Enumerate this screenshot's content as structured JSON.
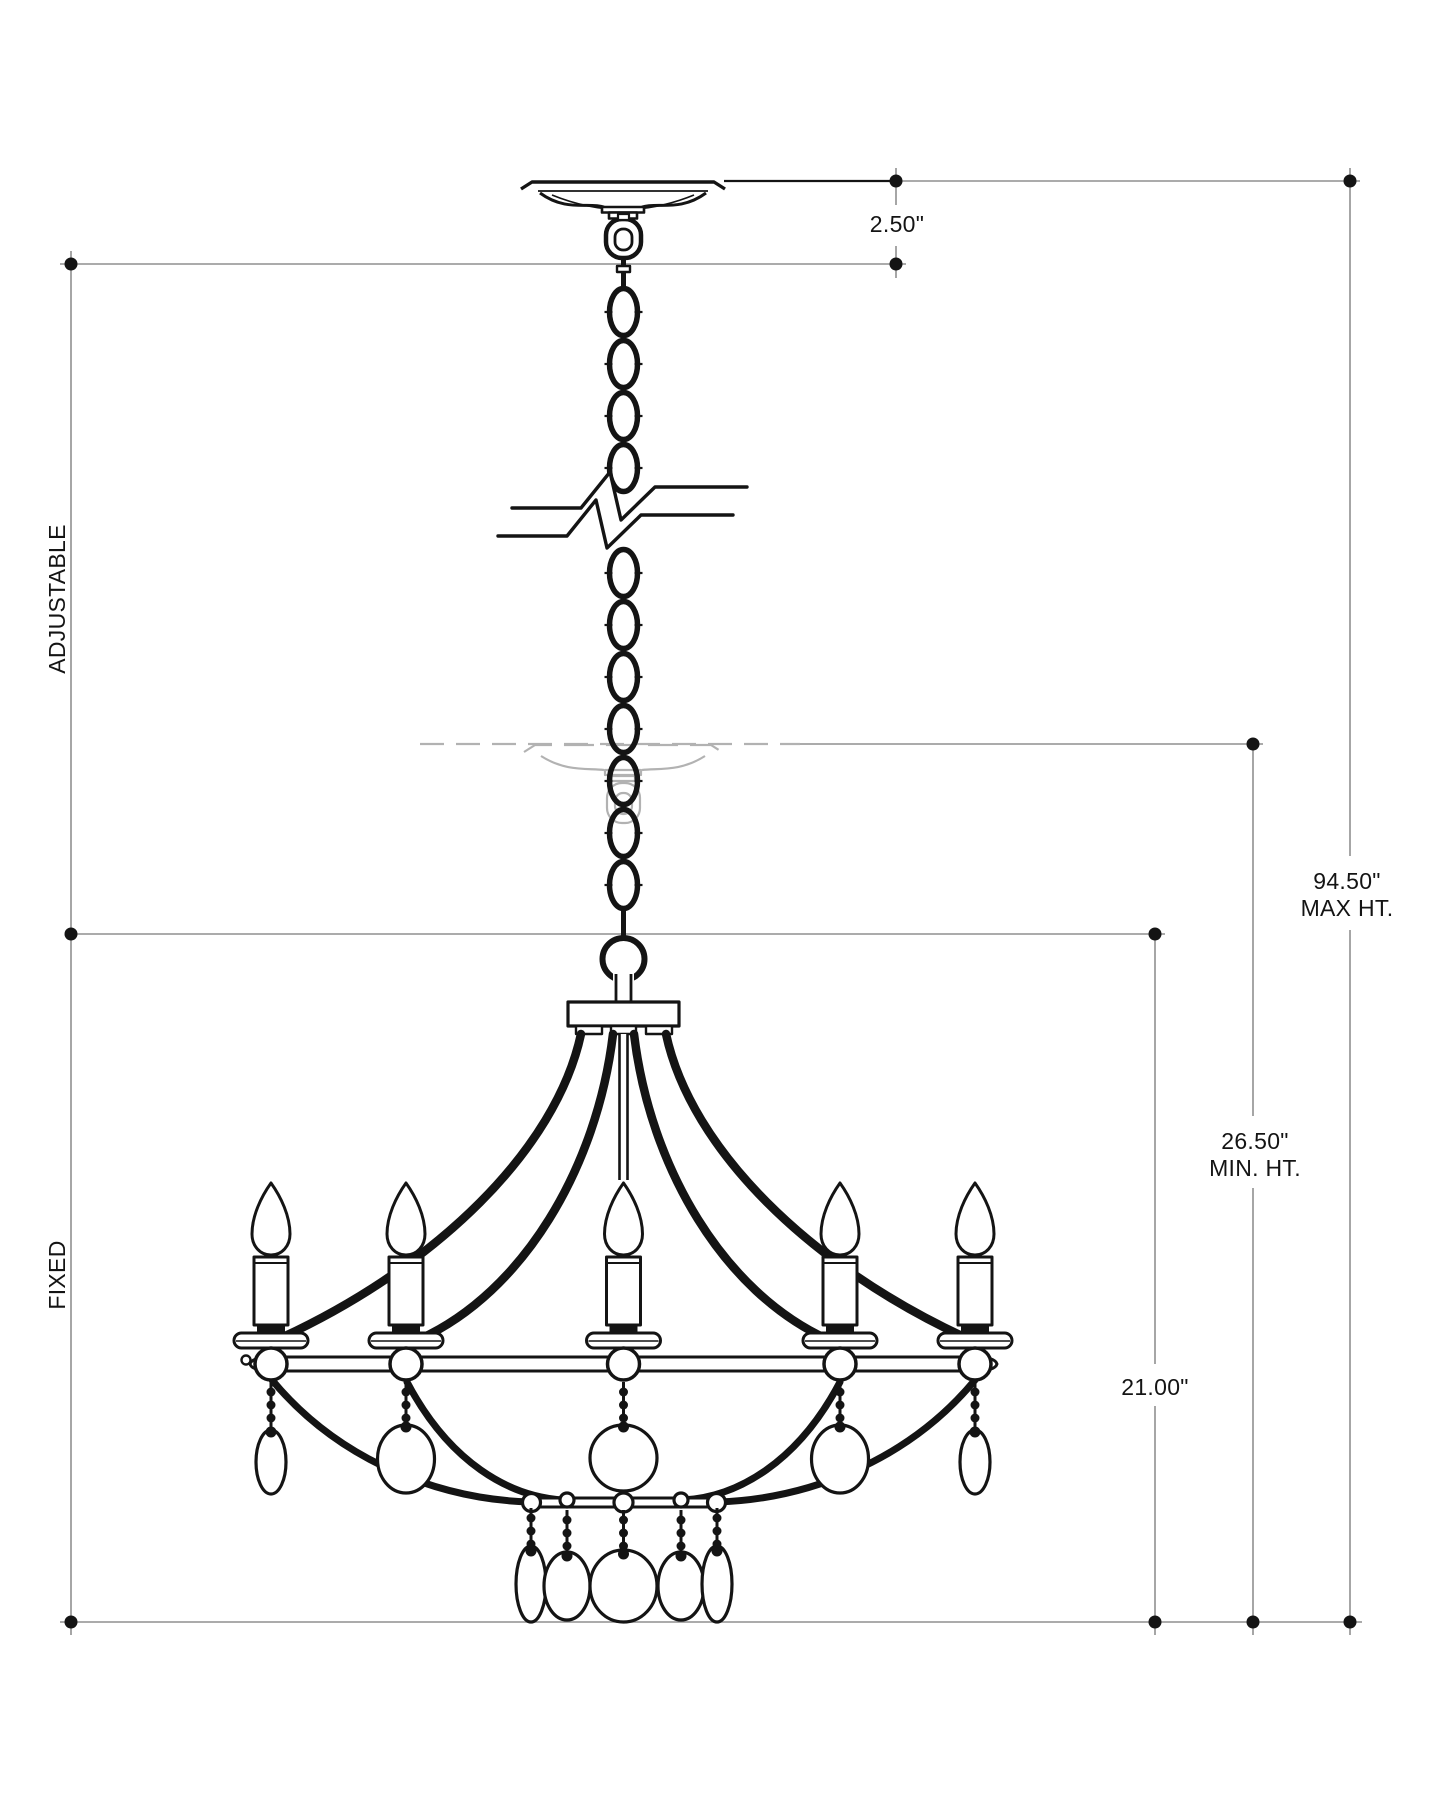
{
  "title": "Chandelier installation dimension drawing",
  "colors": {
    "ink": "#141414",
    "dimline": "#8f8f8f",
    "ghost": "#b2b2b2",
    "paper": "#ffffff"
  },
  "dimensions": {
    "canopy_height": {
      "value": "2.50\""
    },
    "max_height": {
      "value": "94.50\"",
      "caption": "MAX HT."
    },
    "min_height": {
      "value": "26.50\"",
      "caption": "MIN. HT."
    },
    "fixture_height": {
      "value": "21.00\""
    },
    "adjustable_label": "ADJUSTABLE",
    "fixed_label": "FIXED"
  },
  "parts": {
    "canopy": "ceiling-canopy",
    "chain": "hanging-chain",
    "break": "chain-break-symbol",
    "ghost": "raised-canopy-ghost-position",
    "ring": "hanger-ring",
    "hub": "arm-hub",
    "arms": "curved-arms",
    "candles": "candle-lights-x5",
    "band": "candelabra-ring",
    "upper_drops": "upper-crystal-drops-x5",
    "lower_bar": "lower-ring-bar",
    "lower_drops": "lower-crystal-drops-x5"
  }
}
